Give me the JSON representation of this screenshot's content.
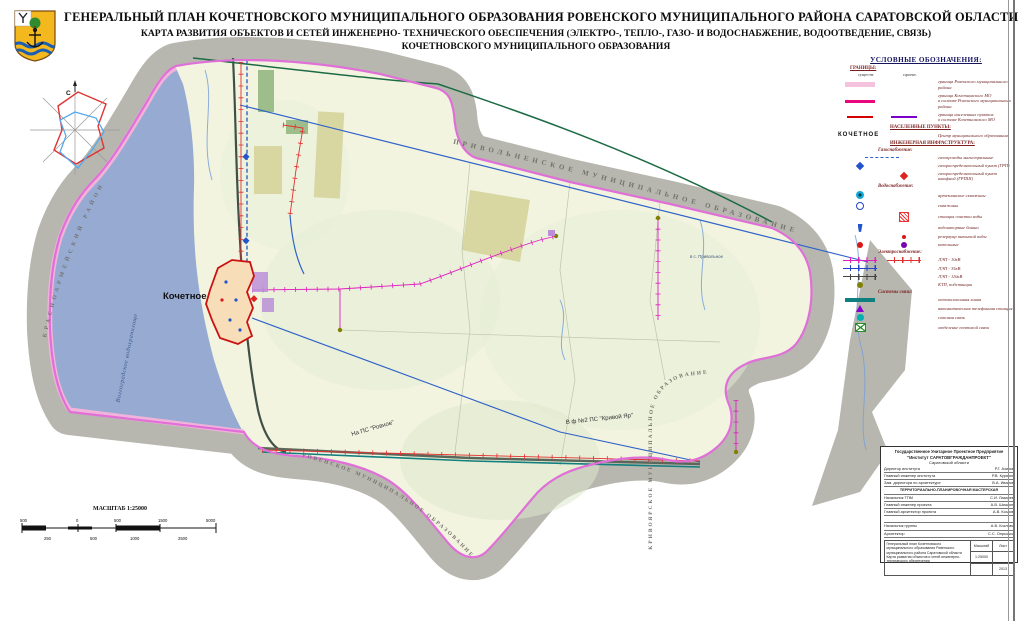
{
  "title": {
    "line1": "ГЕНЕРАЛЬНЫЙ ПЛАН  КОЧЕТНОВСКОГО МУНИЦИПАЛЬНОГО ОБРАЗОВАНИЯ РОВЕНСКОГО МУНИЦИПАЛЬНОГО РАЙОНА САРАТОВСКОЙ ОБЛАСТИ",
    "line2": "КАРТА РАЗВИТИЯ ОБЪЕКТОВ И СЕТЕЙ ИНЖЕНЕРНО- ТЕХНИЧЕСКОГО ОБЕСПЕЧЕНИЯ (ЭЛЕКТРО-, ТЕПЛО-, ГАЗО- И ВОДОСНАБЖЕНИЕ, ВОДООТВЕДЕНИЕ, СВЯЗЬ)",
    "line3": "КОЧЕТНОВСКОГО МУНИЦИПАЛЬНОГО ОБРАЗОВАНИЯ"
  },
  "map": {
    "labels": {
      "settlement": "Кочетное",
      "water": "Волгоградское водохранилище",
      "left_district": "КРАСНОАРМЕЙСКИЙ  РАЙОН",
      "top_mo": "ПРИВОЛЬНЕНСКОЕ  МУНИЦИПАЛЬНОЕ  ОБРАЗОВАНИЕ",
      "bottom_mo": "РОВЕНСКОЕ  МУНИЦИПАЛЬНОЕ  ОБРАЗОВАНИЕ",
      "right_mo": "КРИВОЯРСКОЕ  МУНИЦИПАЛЬНОЕ  ОБРАЗОВАНИЕ",
      "ps_rovnoe": "На ПС \"Ровное\"",
      "ps_krivoy_yar": "В ф №2 ПС \"Кривой Яр\"",
      "to_privolnoe": "в с. Привольное",
      "compass_north": "С"
    },
    "colors": {
      "water": "#97aad2",
      "territory": "#f3f4e0",
      "neighbor_band": "#b7b7af",
      "mo_boundary": "#e06fd8",
      "district_band": "#f2b3da",
      "settlement_outline": "#cc1111",
      "gas_line": "#2f62c8",
      "lep_10kv": "#e020c0",
      "lep_project": "#e03131",
      "fiber_line": "#147f7f",
      "road": "#3f5147"
    }
  },
  "legend": {
    "title": "УСЛОВНЫЕ ОБОЗНАЧЕНИЯ:",
    "borders_header": "ГРАНИЦЫ:",
    "col_existing": "существ.",
    "col_project": "проект.",
    "b1": "граница Ровенского муниципального района",
    "b2a": "граница Кочетновского МО",
    "b2b": "в составе Ровенского муниципального района",
    "b3a": "граница населенных пунктов",
    "b3b": "в составе Кочетновского МО",
    "settlements_header": "НАСЕЛЕННЫЕ ПУНКТЫ:",
    "settlement_sample": "КОЧЕТНОЕ",
    "settlement_label": "Центр муниципального образования",
    "infra_header": "ИНЖЕНЕРНАЯ ИНФРАСТРУКТУРА:",
    "gas_header": "Газоснабжение:",
    "gas1": "газопроводы магистральные",
    "gas2": "газораспределительный пункт (ГРП)",
    "gas3": "газораспределительный пункт шкафной (ГРПШ)",
    "water_header": "Водоснабжение:",
    "w1": "артезианские скважины",
    "w2": "скважины",
    "w3": "станция очистки воды",
    "w4": "водонапорные башни",
    "w5": "резервуар питьевой воды",
    "w6": "котельные",
    "el_header": "Электроснабжение:",
    "e1": "ЛЭП - 10кВ",
    "e2": "ЛЭП - 35кВ",
    "e3": "ЛЭП - 110кВ",
    "e4": "КТП, подстанции",
    "comm_header": "Системы связи:",
    "c1": "оптоволоконная линия",
    "c2": "автоматическая телефонная станция",
    "c3": "сотовая связь",
    "c4": "отделение почтовой связи"
  },
  "scale": {
    "title": "МАСШТАБ 1:25000",
    "top": [
      "500",
      "0",
      "500",
      "1500",
      "5000"
    ],
    "bottom": [
      "250",
      "500",
      "1000",
      "2500"
    ]
  },
  "stamp": {
    "org1": "Государственное Унитарное Проектное Предприятие",
    "org2": "\"Институт САРАТОВГРАЖДАНПРОЕКТ\"",
    "org3": "Саратовской области",
    "r1l": "Директор института",
    "r1v": "Р.Г. Азизов",
    "r2l": "Главный инженер института",
    "r2v": "Р.В. Курякин",
    "r3l": "Зам. директора по архитектуре",
    "r3v": "В.А. Иванов",
    "band": "ТЕРРИТОРИАЛЬНО-ПЛАНИРОВОЧНАЯ МАСТЕРСКАЯ",
    "r4l": "Начальник ТПМ",
    "r4v": "С.И. Лазарев",
    "r5l": "Главный инженер проекта",
    "r5v": "А.В. Шишкин",
    "r6l": "Главный архитектор проекта",
    "r6v": "А.В. Козлов",
    "r7l": "Начальник группы",
    "r7v": "А.В. Козлова",
    "r8l": "Архитектор",
    "r8v": "С.С. Опрышко",
    "obj1": "Генеральный план Кочетновского муниципального образования Ровенского муниципального района Саратовской области",
    "obj2": "Карта развития объектов и сетей инженерно-технического обеспечения",
    "scale_label": "Масштаб",
    "sheet_label": "Лист",
    "scale_value": "1:25000",
    "year": "2013"
  }
}
